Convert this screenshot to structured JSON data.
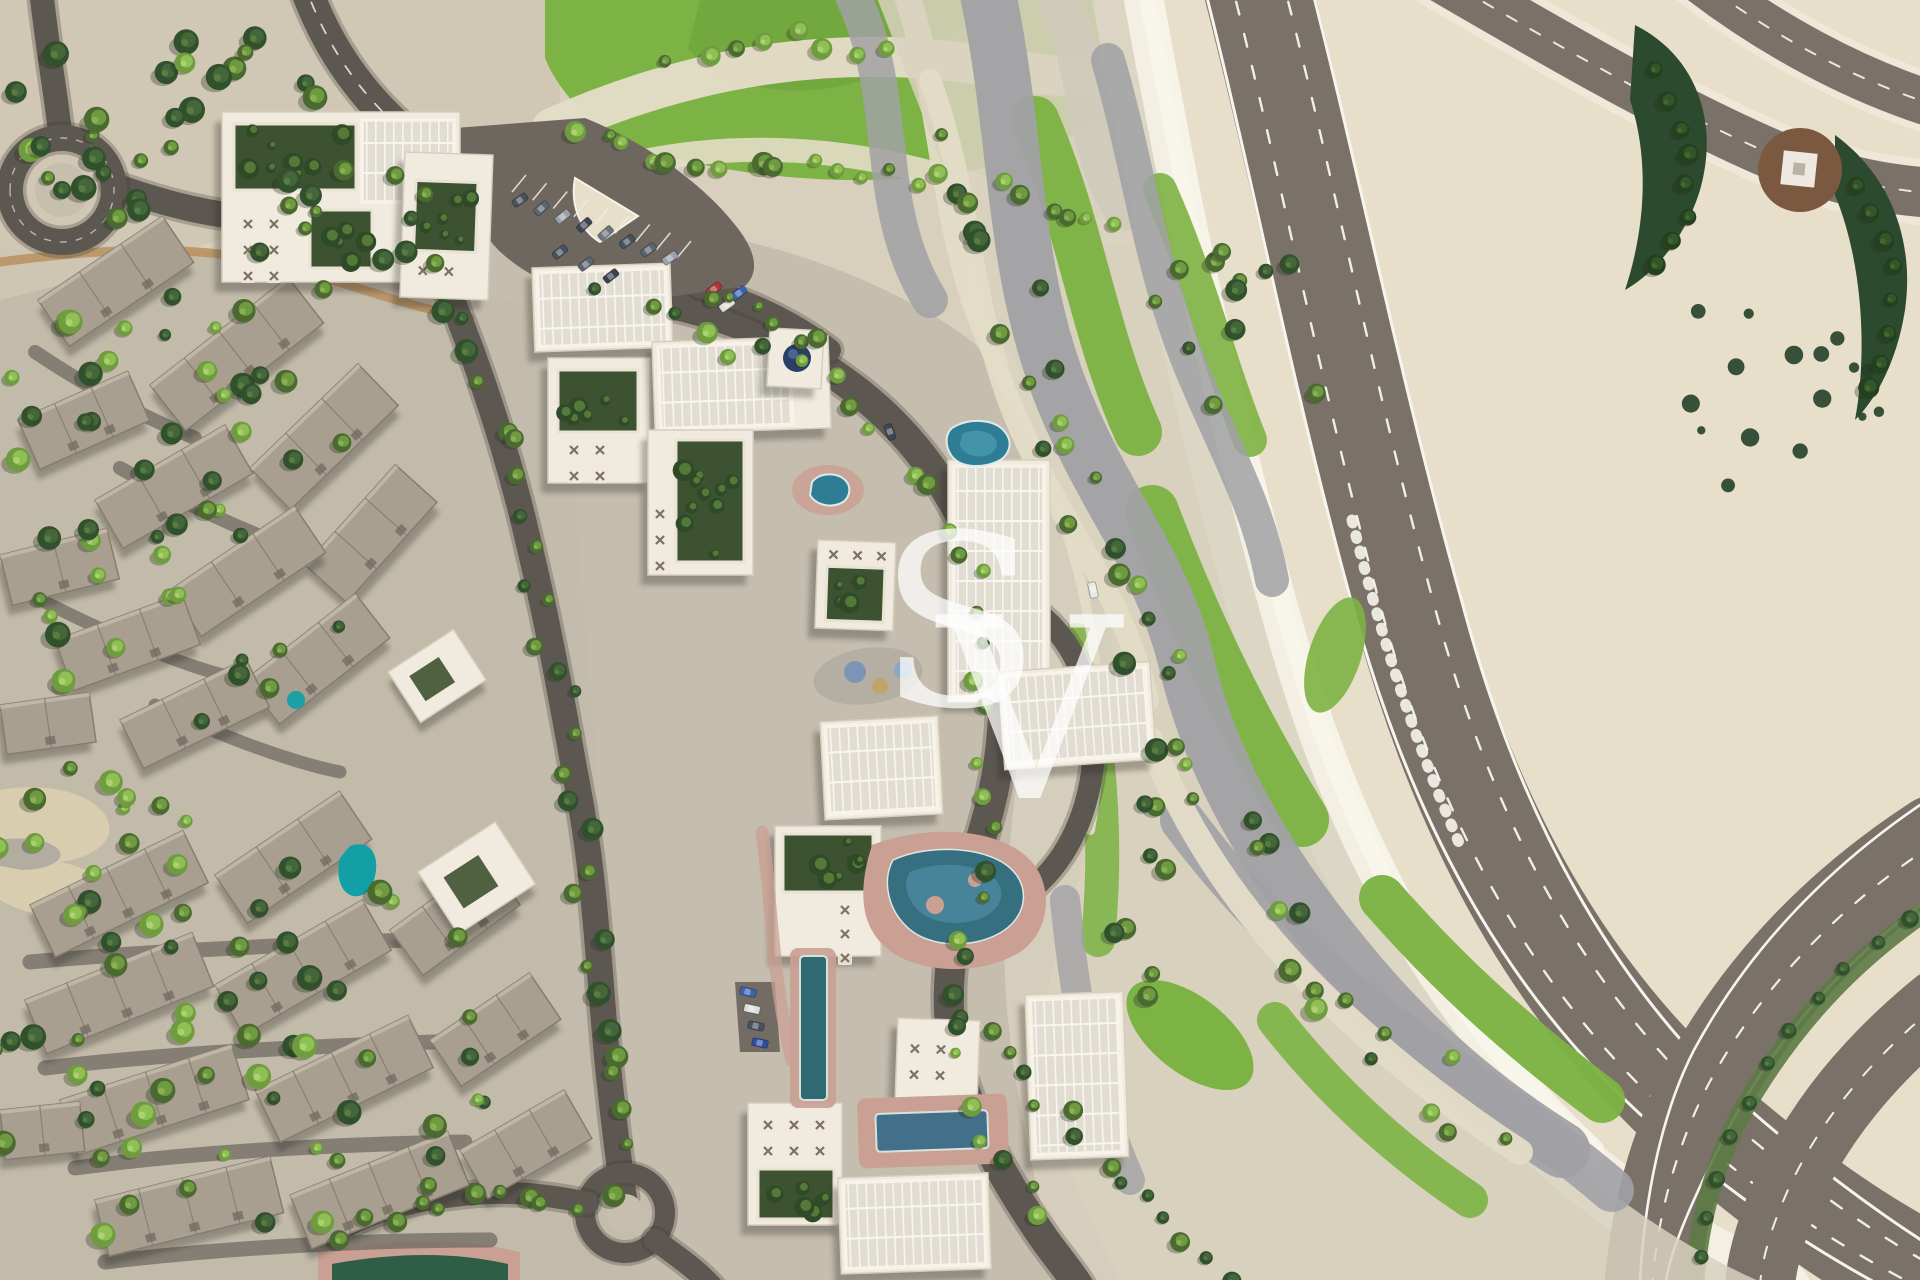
{
  "scene": {
    "type": "aerial-masterplan-render",
    "description": "Aerial 3D render of a residential master plan: townhouse district with dense trees on the left, central apartment cluster with solar-panel roofs, courtyards and swimming pools, wavy gravel-and-grass landscape buffer, and a curved multi-lane highway interchange on the right.",
    "watermark": {
      "letters": "SV",
      "letter_s": "S",
      "letter_v": "V"
    },
    "palette": {
      "sand": "#d8cfbc",
      "sand_dark": "#c7bfad",
      "cream": "#e7dfca",
      "white_concrete": "#f3efe3",
      "grass": "#7db344",
      "grass_dark": "#699e38",
      "gravel_gray": "#a1a1a5",
      "gravel_light": "#e3dcc7",
      "asphalt_highway": "#7a7168",
      "asphalt_road": "#5d5751",
      "asphalt_parking": "#6e6760",
      "villa_roof": "#a89f90",
      "villa_roof_edge": "#857d6e",
      "building_white": "#f1ebdf",
      "building_edge": "#d6cebd",
      "panel_roof": "#e2ddd2",
      "panel_line": "#f7f5ee",
      "court_green": "#3d5230",
      "tree_dark": "#31512c",
      "tree_mid": "#4a6a31",
      "tree_light": "#8fb958",
      "pool_teal": "#2e7d95",
      "pool_bright": "#12a0a6",
      "pool_lap": "#42708a",
      "deck_pink": "#c9a093",
      "lane_white": "#f6f4ee",
      "dome_blue": "#2b3f66",
      "watermark_white": "#ffffff"
    }
  }
}
